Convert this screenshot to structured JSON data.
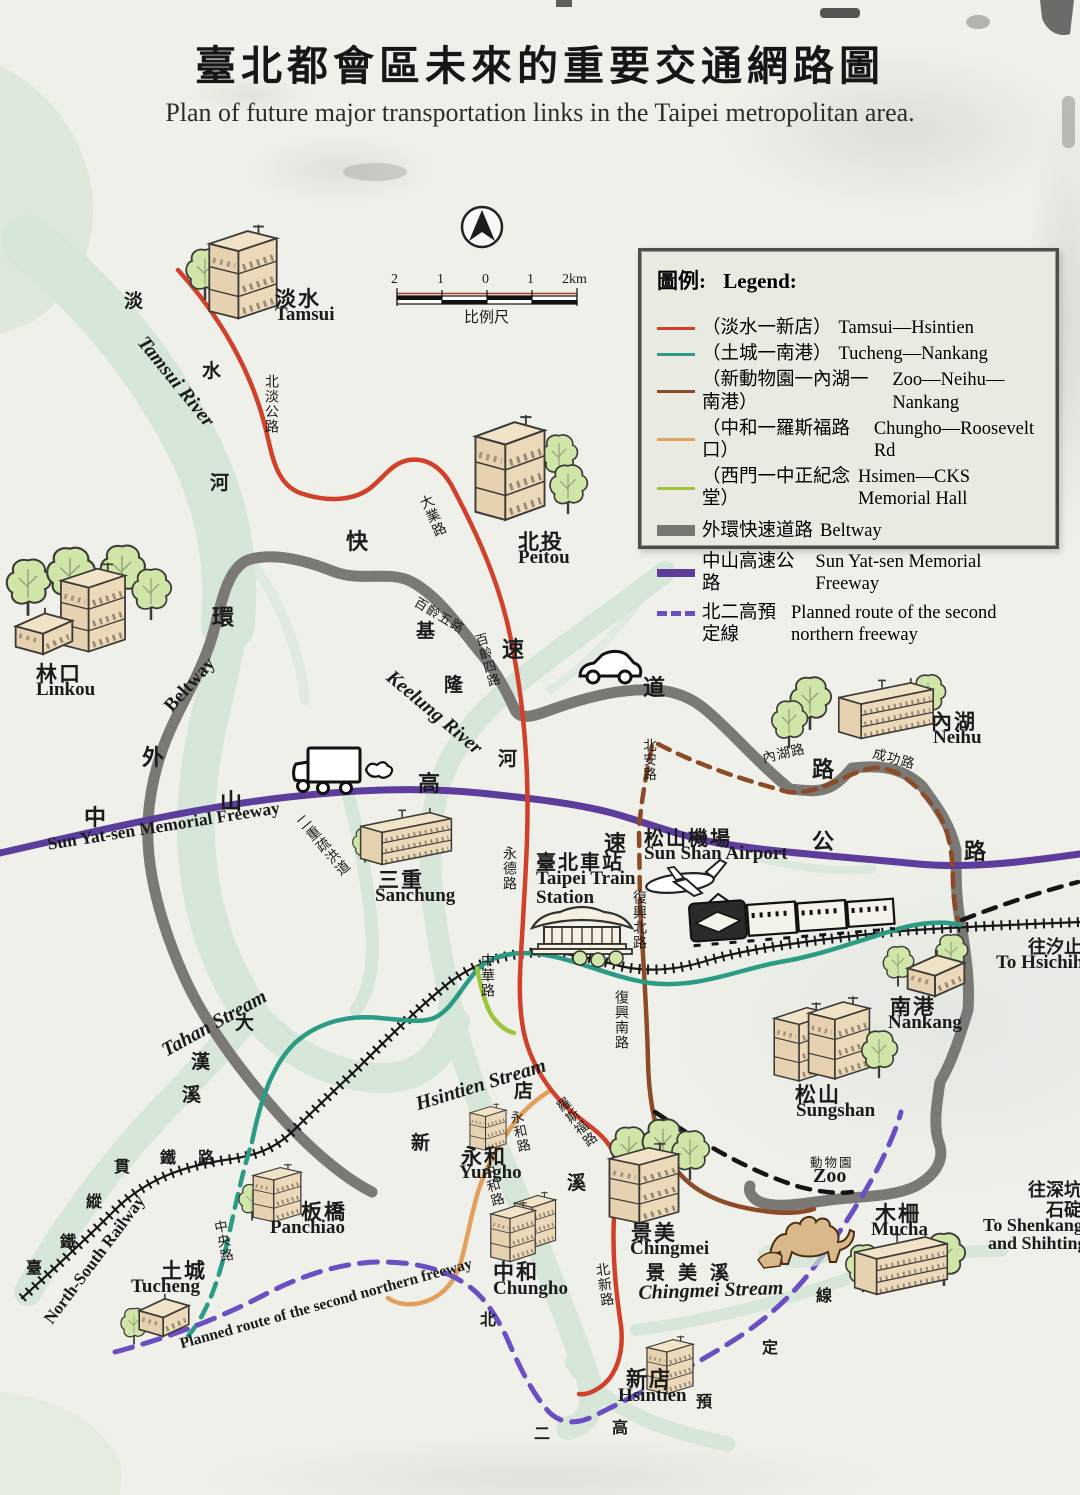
{
  "header": {
    "title_zh": "臺北都會區未來的重要交通網路圖",
    "title_en": "Plan of future major transportation links in the Taipei metropolitan area."
  },
  "legend": {
    "title_zh": "圖例:",
    "title_en": "Legend:",
    "items": [
      {
        "zh": "（淡水一新店）",
        "en": "Tamsui—Hsintien"
      },
      {
        "zh": "（土城一南港）",
        "en": "Tucheng—Nankang"
      },
      {
        "zh": "（新動物園一內湖一南港）",
        "en": "Zoo—Neihu—Nankang"
      },
      {
        "zh": "（中和一羅斯福路口）",
        "en": "Chungho—Roosevelt Rd"
      },
      {
        "zh": "（西門一中正紀念堂）",
        "en": "Hsimen—CKS Memorial Hall"
      },
      {
        "zh": "外環快速道路",
        "en": "Beltway"
      },
      {
        "zh": "中山高速公路",
        "en": "Sun Yat-sen Memorial Freeway"
      },
      {
        "zh": "北二高預定線",
        "en": "Planned route of the second northern freeway"
      }
    ]
  },
  "scale": {
    "ticks": [
      "2",
      "1",
      "0",
      "1",
      "2km"
    ],
    "caption": "比例尺"
  },
  "routes": {
    "beltway": {
      "zh": "外環快速道路",
      "en": "Beltway"
    },
    "freeway": {
      "zh": "中山高速公路",
      "en": "Sun Yat-sen Memorial Freeway"
    },
    "railway": {
      "zh": "臺鐵縱貫鐵路",
      "en": "North-South Railway"
    },
    "second_freeway": {
      "zh": "北二高預定線",
      "en": "Planned route of the second northern freeway"
    }
  },
  "waterways": {
    "tamsui_river": {
      "zh": "淡水河",
      "en": "Tamsui River"
    },
    "keelung_river": {
      "zh": "基隆河",
      "en": "Keelung River"
    },
    "tahan_stream": {
      "zh": "大漢溪",
      "en": "Tahan Stream"
    },
    "hsintien_stream": {
      "zh": "新店溪",
      "en": "Hsintien Stream"
    },
    "chingmei_stream": {
      "zh": "景美溪",
      "en": "Chingmei Stream"
    },
    "erchong_floodway": {
      "zh": "二重疏洪道"
    }
  },
  "roads": {
    "peitan": "北淡公路",
    "taye": "大業路",
    "bailing5": "百齡五路",
    "bailing4": "百齡四路",
    "yungte": "永德路",
    "fuxing_n": "復興北路",
    "fuxing_s": "復興南路",
    "chunghwa": "中華路",
    "roosevelt": "羅斯福路",
    "peihsin": "北新路",
    "yungho_rd": "永和路",
    "chungho_rd": "中和路",
    "chungyang": "中央路",
    "neihu_rd": "內湖路",
    "chenggong": "成功路",
    "peian": "北安路"
  },
  "places": {
    "tamsui": {
      "zh": "淡水",
      "en": "Tamsui"
    },
    "peitou": {
      "zh": "北投",
      "en": "Peitou"
    },
    "linkou": {
      "zh": "林口",
      "en": "Linkou"
    },
    "sanchung": {
      "zh": "三重",
      "en": "Sanchung"
    },
    "taipei_station": {
      "zh": "臺北車站",
      "en1": "Taipei Train",
      "en2": "Station"
    },
    "sunshan_airport": {
      "zh": "松山機場",
      "en": "Sun Shan Airport"
    },
    "neihu": {
      "zh": "內湖",
      "en": "Neihu"
    },
    "nankang": {
      "zh": "南港",
      "en": "Nankang"
    },
    "sungshan": {
      "zh": "松山",
      "en": "Sungshan"
    },
    "mucha": {
      "zh": "木柵",
      "en": "Mucha"
    },
    "chingmei": {
      "zh": "景美",
      "en": "Chingmei"
    },
    "yungho": {
      "zh": "永和",
      "en": "Yungho"
    },
    "chungho": {
      "zh": "中和",
      "en": "Chungho"
    },
    "panchiao": {
      "zh": "板橋",
      "en": "Panchiao"
    },
    "tucheng": {
      "zh": "土城",
      "en": "Tucheng"
    },
    "hsintien": {
      "zh": "新店",
      "en": "Hsintien"
    },
    "zoo": {
      "zh": "動物園",
      "en": "Zoo"
    }
  },
  "destinations": {
    "hsichih": {
      "zh": "往汐止",
      "en": "To Hsichih"
    },
    "shenkang": {
      "zh1": "往深坑",
      "zh2": "石碇",
      "en1": "To Shenkang",
      "en2": "and Shihting"
    }
  },
  "icons": {
    "compass": "north-arrow",
    "car": "car",
    "truck": "truck",
    "train": "train",
    "airplane": "airplane",
    "camel": "camel"
  },
  "colors": {
    "line_red": "#d0402a",
    "line_teal": "#2a9b85",
    "line_brown": "#8c4a26",
    "line_orange": "#e2a05c",
    "line_lightgreen": "#9ec43e",
    "beltway_gray": "#787672",
    "freeway_purple": "#5d3c9c",
    "planned_purple": "#6a4ec2",
    "river_green": "#d6e6d8",
    "building_tan": "#ecd9ba",
    "tree_green": "#cfe6a8"
  }
}
